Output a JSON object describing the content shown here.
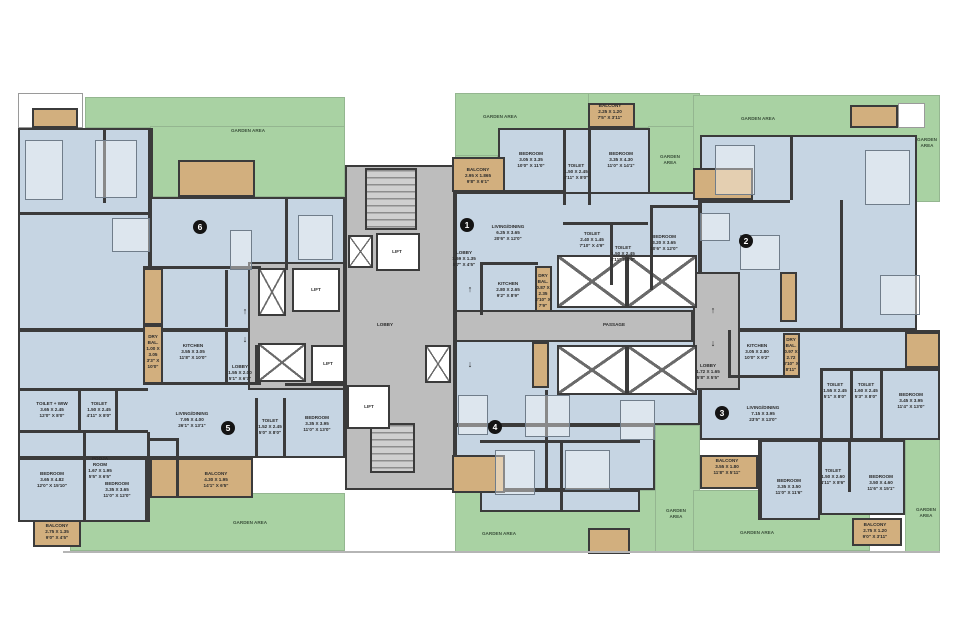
{
  "palette": {
    "garden_green": "#a9d2a3",
    "room_blue": "#c6d5e3",
    "balcony_tan": "#d2af7e",
    "core_gray": "#bdbdbd",
    "wall_dark": "#3b3b3b",
    "badge_black": "#141414",
    "background": "#ffffff"
  },
  "areas": [
    {
      "t": "garden",
      "x": 85,
      "y": 97,
      "w": 260,
      "h": 31
    },
    {
      "t": "garden",
      "x": 150,
      "y": 126,
      "w": 195,
      "h": 71
    },
    {
      "t": "garden",
      "x": 70,
      "y": 493,
      "w": 275,
      "h": 58
    },
    {
      "t": "garden",
      "x": 455,
      "y": 93,
      "w": 137,
      "h": 64
    },
    {
      "t": "garden",
      "x": 455,
      "y": 155,
      "w": 43,
      "h": 47
    },
    {
      "t": "garden",
      "x": 588,
      "y": 93,
      "w": 112,
      "h": 35
    },
    {
      "t": "garden",
      "x": 648,
      "y": 126,
      "w": 52,
      "h": 78
    },
    {
      "t": "garden",
      "x": 455,
      "y": 490,
      "w": 205,
      "h": 62
    },
    {
      "t": "garden",
      "x": 655,
      "y": 425,
      "w": 45,
      "h": 127
    },
    {
      "t": "garden",
      "x": 693,
      "y": 95,
      "w": 247,
      "h": 107
    },
    {
      "t": "garden",
      "x": 693,
      "y": 490,
      "w": 177,
      "h": 61
    },
    {
      "t": "garden",
      "x": 905,
      "y": 428,
      "w": 35,
      "h": 124
    },
    {
      "t": "room",
      "n": "unit-6-interior",
      "x": 18,
      "y": 128,
      "w": 132,
      "h": 202
    },
    {
      "t": "room",
      "n": "unit-6-interior",
      "x": 150,
      "y": 197,
      "w": 195,
      "h": 133
    },
    {
      "t": "room",
      "n": "unit-5-interior",
      "x": 18,
      "y": 330,
      "w": 327,
      "h": 128
    },
    {
      "t": "room",
      "n": "unit-5-interior",
      "x": 18,
      "y": 458,
      "w": 129,
      "h": 64
    },
    {
      "t": "room",
      "n": "unit-1-interior",
      "x": 498,
      "y": 128,
      "w": 152,
      "h": 97
    },
    {
      "t": "room",
      "n": "unit-1-interior",
      "x": 455,
      "y": 192,
      "w": 245,
      "h": 123
    },
    {
      "t": "room",
      "n": "unit-4-interior",
      "x": 455,
      "y": 340,
      "w": 245,
      "h": 85
    },
    {
      "t": "room",
      "n": "unit-4-interior",
      "x": 455,
      "y": 425,
      "w": 200,
      "h": 65
    },
    {
      "t": "room",
      "n": "unit-4-interior",
      "x": 480,
      "y": 490,
      "w": 160,
      "h": 22
    },
    {
      "t": "room",
      "n": "unit-2-interior",
      "x": 700,
      "y": 135,
      "w": 217,
      "h": 195
    },
    {
      "t": "room",
      "n": "unit-3-interior",
      "x": 700,
      "y": 330,
      "w": 240,
      "h": 110
    },
    {
      "t": "room",
      "n": "unit-3-interior",
      "x": 760,
      "y": 440,
      "w": 60,
      "h": 80
    },
    {
      "t": "room",
      "n": "unit-3-interior",
      "x": 820,
      "y": 440,
      "w": 85,
      "h": 75
    },
    {
      "t": "core",
      "n": "stair-lift-core",
      "x": 345,
      "y": 165,
      "w": 110,
      "h": 325
    },
    {
      "t": "core",
      "n": "lift-lobby",
      "x": 248,
      "y": 262,
      "w": 97,
      "h": 128
    },
    {
      "t": "core",
      "n": "passage",
      "x": 455,
      "y": 310,
      "w": 238,
      "h": 32
    },
    {
      "t": "core",
      "n": "entrance-lobby",
      "x": 693,
      "y": 272,
      "w": 47,
      "h": 118
    },
    {
      "t": "terrace",
      "x": 18,
      "y": 93,
      "w": 65,
      "h": 35
    },
    {
      "t": "terrace",
      "x": 898,
      "y": 103,
      "w": 27,
      "h": 25
    },
    {
      "t": "balcony",
      "x": 32,
      "y": 108,
      "w": 46,
      "h": 20
    },
    {
      "t": "balcony",
      "x": 178,
      "y": 160,
      "w": 77,
      "h": 37
    },
    {
      "t": "balcony",
      "x": 143,
      "y": 268,
      "w": 20,
      "h": 57
    },
    {
      "t": "balcony",
      "x": 143,
      "y": 325,
      "w": 20,
      "h": 60
    },
    {
      "t": "balcony",
      "x": 150,
      "y": 458,
      "w": 103,
      "h": 40
    },
    {
      "t": "balcony",
      "x": 33,
      "y": 520,
      "w": 48,
      "h": 27
    },
    {
      "t": "balcony",
      "x": 452,
      "y": 157,
      "w": 53,
      "h": 35
    },
    {
      "t": "balcony",
      "x": 588,
      "y": 103,
      "w": 47,
      "h": 25
    },
    {
      "t": "balcony",
      "x": 535,
      "y": 266,
      "w": 17,
      "h": 46
    },
    {
      "t": "balcony",
      "x": 532,
      "y": 342,
      "w": 17,
      "h": 46
    },
    {
      "t": "balcony",
      "x": 452,
      "y": 455,
      "w": 53,
      "h": 38
    },
    {
      "t": "balcony",
      "x": 588,
      "y": 528,
      "w": 42,
      "h": 26
    },
    {
      "t": "balcony",
      "x": 693,
      "y": 168,
      "w": 60,
      "h": 32
    },
    {
      "t": "balcony",
      "x": 850,
      "y": 105,
      "w": 48,
      "h": 23
    },
    {
      "t": "balcony",
      "x": 780,
      "y": 272,
      "w": 17,
      "h": 50
    },
    {
      "t": "balcony",
      "x": 905,
      "y": 332,
      "w": 35,
      "h": 36
    },
    {
      "t": "balcony",
      "x": 783,
      "y": 333,
      "w": 17,
      "h": 44
    },
    {
      "t": "balcony",
      "x": 700,
      "y": 455,
      "w": 58,
      "h": 34
    },
    {
      "t": "balcony",
      "x": 852,
      "y": 518,
      "w": 50,
      "h": 28
    }
  ],
  "voids": [
    {
      "x": 258,
      "y": 268,
      "w": 28,
      "h": 48
    },
    {
      "x": 348,
      "y": 235,
      "w": 25,
      "h": 33
    },
    {
      "x": 258,
      "y": 343,
      "w": 48,
      "h": 39
    },
    {
      "x": 425,
      "y": 345,
      "w": 26,
      "h": 38
    },
    {
      "x": 557,
      "y": 255,
      "w": 70,
      "h": 53
    },
    {
      "x": 627,
      "y": 255,
      "w": 70,
      "h": 53
    },
    {
      "x": 557,
      "y": 345,
      "w": 70,
      "h": 50
    },
    {
      "x": 627,
      "y": 345,
      "w": 70,
      "h": 50
    }
  ],
  "stairs": [
    {
      "x": 365,
      "y": 168,
      "w": 52,
      "h": 62
    },
    {
      "x": 370,
      "y": 423,
      "w": 45,
      "h": 50
    }
  ],
  "lifts": [
    {
      "x": 292,
      "y": 268,
      "w": 48,
      "h": 44
    },
    {
      "x": 376,
      "y": 233,
      "w": 44,
      "h": 38
    },
    {
      "x": 311,
      "y": 345,
      "w": 34,
      "h": 38
    },
    {
      "x": 347,
      "y": 385,
      "w": 43,
      "h": 44
    }
  ],
  "walls": [
    {
      "x": 225,
      "y": 328,
      "w": 3,
      "h": 57
    },
    {
      "x": 143,
      "y": 382,
      "w": 118,
      "h": 3
    },
    {
      "x": 255,
      "y": 345,
      "w": 3,
      "h": 40
    },
    {
      "x": 255,
      "y": 398,
      "w": 3,
      "h": 60
    },
    {
      "x": 283,
      "y": 398,
      "w": 3,
      "h": 60
    },
    {
      "x": 285,
      "y": 383,
      "w": 60,
      "h": 3
    },
    {
      "x": 18,
      "y": 388,
      "w": 130,
      "h": 3
    },
    {
      "x": 78,
      "y": 390,
      "w": 3,
      "h": 42
    },
    {
      "x": 115,
      "y": 390,
      "w": 3,
      "h": 42
    },
    {
      "x": 18,
      "y": 430,
      "w": 130,
      "h": 3
    },
    {
      "x": 83,
      "y": 432,
      "w": 3,
      "h": 90
    },
    {
      "x": 147,
      "y": 432,
      "w": 3,
      "h": 90
    },
    {
      "x": 147,
      "y": 438,
      "w": 30,
      "h": 3
    },
    {
      "x": 176,
      "y": 438,
      "w": 3,
      "h": 60
    },
    {
      "x": 225,
      "y": 270,
      "w": 3,
      "h": 57
    },
    {
      "x": 143,
      "y": 266,
      "w": 118,
      "h": 3
    },
    {
      "x": 285,
      "y": 197,
      "w": 3,
      "h": 73
    },
    {
      "x": 150,
      "y": 128,
      "w": 3,
      "h": 70
    },
    {
      "x": 103,
      "y": 128,
      "w": 3,
      "h": 75
    },
    {
      "x": 18,
      "y": 212,
      "w": 132,
      "h": 3
    },
    {
      "x": 563,
      "y": 128,
      "w": 3,
      "h": 77
    },
    {
      "x": 588,
      "y": 128,
      "w": 3,
      "h": 77
    },
    {
      "x": 498,
      "y": 190,
      "w": 65,
      "h": 3
    },
    {
      "x": 650,
      "y": 205,
      "w": 50,
      "h": 3
    },
    {
      "x": 650,
      "y": 205,
      "w": 3,
      "h": 85
    },
    {
      "x": 563,
      "y": 222,
      "w": 85,
      "h": 3
    },
    {
      "x": 610,
      "y": 225,
      "w": 3,
      "h": 60
    },
    {
      "x": 480,
      "y": 262,
      "w": 3,
      "h": 53
    },
    {
      "x": 480,
      "y": 262,
      "w": 58,
      "h": 3
    },
    {
      "x": 728,
      "y": 330,
      "w": 3,
      "h": 48
    },
    {
      "x": 728,
      "y": 375,
      "w": 72,
      "h": 3
    },
    {
      "x": 820,
      "y": 368,
      "w": 3,
      "h": 72
    },
    {
      "x": 850,
      "y": 368,
      "w": 3,
      "h": 72
    },
    {
      "x": 880,
      "y": 368,
      "w": 3,
      "h": 72
    },
    {
      "x": 820,
      "y": 368,
      "w": 120,
      "h": 3
    },
    {
      "x": 758,
      "y": 440,
      "w": 3,
      "h": 80
    },
    {
      "x": 848,
      "y": 440,
      "w": 3,
      "h": 52
    },
    {
      "x": 790,
      "y": 135,
      "w": 3,
      "h": 65
    },
    {
      "x": 840,
      "y": 200,
      "w": 3,
      "h": 130
    },
    {
      "x": 700,
      "y": 200,
      "w": 90,
      "h": 3
    },
    {
      "x": 545,
      "y": 390,
      "w": 3,
      "h": 100
    },
    {
      "x": 480,
      "y": 440,
      "w": 160,
      "h": 3
    },
    {
      "x": 560,
      "y": 442,
      "w": 3,
      "h": 70
    }
  ],
  "edges": [
    {
      "x": 63,
      "y": 551,
      "w": 877,
      "h": 2
    }
  ],
  "furniture": [
    {
      "n": "bed",
      "x": 25,
      "y": 140,
      "w": 38,
      "h": 60
    },
    {
      "n": "bed",
      "x": 95,
      "y": 140,
      "w": 42,
      "h": 58
    },
    {
      "n": "dining-table",
      "x": 112,
      "y": 218,
      "w": 38,
      "h": 34
    },
    {
      "n": "sofa",
      "x": 230,
      "y": 230,
      "w": 22,
      "h": 40
    },
    {
      "n": "bed",
      "x": 298,
      "y": 215,
      "w": 35,
      "h": 45
    },
    {
      "n": "bed",
      "x": 715,
      "y": 145,
      "w": 40,
      "h": 50
    },
    {
      "n": "bed",
      "x": 865,
      "y": 150,
      "w": 45,
      "h": 55
    },
    {
      "n": "dining-table",
      "x": 740,
      "y": 235,
      "w": 40,
      "h": 35
    },
    {
      "n": "sofa",
      "x": 700,
      "y": 213,
      "w": 30,
      "h": 28
    },
    {
      "n": "bed",
      "x": 880,
      "y": 275,
      "w": 40,
      "h": 40
    },
    {
      "n": "sofa",
      "x": 458,
      "y": 395,
      "w": 30,
      "h": 40
    },
    {
      "n": "dining-table",
      "x": 525,
      "y": 395,
      "w": 45,
      "h": 42
    },
    {
      "n": "bed",
      "x": 495,
      "y": 450,
      "w": 40,
      "h": 45
    },
    {
      "n": "bed",
      "x": 565,
      "y": 450,
      "w": 45,
      "h": 40
    },
    {
      "n": "bed",
      "x": 620,
      "y": 400,
      "w": 35,
      "h": 40
    }
  ],
  "labels": [
    {
      "g": true,
      "t": "GARDEN AREA",
      "x": 248,
      "y": 131,
      "w": 60
    },
    {
      "g": true,
      "t": "GARDEN AREA",
      "x": 250,
      "y": 523,
      "w": 60
    },
    {
      "g": true,
      "t": "GARDEN AREA",
      "x": 500,
      "y": 117,
      "w": 60
    },
    {
      "g": true,
      "t": "GARDEN\nAREA",
      "x": 670,
      "y": 160,
      "w": 32
    },
    {
      "g": true,
      "t": "GARDEN AREA",
      "x": 499,
      "y": 534,
      "w": 60
    },
    {
      "g": true,
      "t": "GARDEN\nAREA",
      "x": 676,
      "y": 514,
      "w": 32
    },
    {
      "g": true,
      "t": "GARDEN AREA",
      "x": 758,
      "y": 119,
      "w": 60
    },
    {
      "g": true,
      "t": "GARDEN\nAREA",
      "x": 927,
      "y": 143,
      "w": 32
    },
    {
      "g": true,
      "t": "GARDEN AREA",
      "x": 757,
      "y": 533,
      "w": 60
    },
    {
      "g": true,
      "t": "GARDEN\nAREA",
      "x": 926,
      "y": 513,
      "w": 32
    },
    {
      "t": "DRY\nBAL.\n1.00 X\n3.05\n3'3\" X\n10'0\"",
      "x": 153,
      "y": 352,
      "w": 20
    },
    {
      "t": "KITCHEN\n3.55 X 3.05\n11'8\" X 10'0\"",
      "x": 193,
      "y": 352,
      "w": 55
    },
    {
      "t": "LOBBY\n1.55 X 2.00\n5'1\" X 6'7\"",
      "x": 240,
      "y": 373,
      "w": 42
    },
    {
      "t": "LIVING/DINING\n7.95 X 4.00\n26'1\" X 13'1\"",
      "x": 192,
      "y": 420,
      "w": 62
    },
    {
      "t": "TOILET\n1.52 X 2.45\n5'0\" X 8'0\"",
      "x": 270,
      "y": 427,
      "w": 40
    },
    {
      "t": "BEDROOM\n3.35 X 3.95\n11'0\" X 13'0\"",
      "x": 317,
      "y": 424,
      "w": 52
    },
    {
      "t": "POOJA\nROOM\n1.67 X 1.95\n5'5\" X 6'5\"",
      "x": 100,
      "y": 468,
      "w": 40
    },
    {
      "t": "BALCONY\n4.30 X 1.95\n14'1\" X 6'5\"",
      "x": 216,
      "y": 480,
      "w": 52
    },
    {
      "t": "TOILET + WIW\n3.65 X 2.45\n12'0\" X 8'0\"",
      "x": 52,
      "y": 410,
      "w": 55
    },
    {
      "t": "TOILET\n1.50 X 2.45\n4'11\" X 8'0\"",
      "x": 99,
      "y": 410,
      "w": 40
    },
    {
      "t": "BEDROOM\n3.65 X 4.82\n12'0\" X 15'10\"",
      "x": 52,
      "y": 480,
      "w": 52
    },
    {
      "t": "BEDROOM\n3.35 X 3.65\n11'0\" X 12'0\"",
      "x": 117,
      "y": 490,
      "w": 52
    },
    {
      "t": "BALCONY\n2.75 X 1.35\n9'0\" X 4'5\"",
      "x": 57,
      "y": 532,
      "w": 45
    },
    {
      "t": "LIFT",
      "x": 316,
      "y": 290,
      "w": 30
    },
    {
      "t": "LIFT",
      "x": 397,
      "y": 252,
      "w": 30
    },
    {
      "t": "LIFT",
      "x": 328,
      "y": 364,
      "w": 30
    },
    {
      "t": "LIFT",
      "x": 369,
      "y": 407,
      "w": 30
    },
    {
      "t": "LOBBY",
      "x": 385,
      "y": 325,
      "w": 40
    },
    {
      "t": "PASSAGE",
      "x": 614,
      "y": 325,
      "w": 50
    },
    {
      "t": "BALCONY\n2.95 X 1.865\n9'8\" X 6'1\"",
      "x": 478,
      "y": 176,
      "w": 52
    },
    {
      "t": "BALCONY\n2.25 X 1.20\n7'5\" X 3'11\"",
      "x": 610,
      "y": 112,
      "w": 48
    },
    {
      "t": "BEDROOM\n3.05 X 3.35\n10'0\" X 11'0\"",
      "x": 531,
      "y": 160,
      "w": 52
    },
    {
      "t": "TOILET\n1.50 X 2.45\n4'11\" X 8'0\"",
      "x": 576,
      "y": 172,
      "w": 30
    },
    {
      "t": "BEDROOM\n3.35 X 4.30\n11'0\" X 14'1\"",
      "x": 621,
      "y": 160,
      "w": 52
    },
    {
      "t": "LIVING/DINING\n6.25 X 3.65\n20'6\" X 12'0\"",
      "x": 508,
      "y": 233,
      "w": 62
    },
    {
      "t": "TOILET\n2.40 X 1.45\n7'10\" X 4'9\"",
      "x": 592,
      "y": 240,
      "w": 45
    },
    {
      "t": "TOILET\n1.50 X 2.45\n4'11\" X 8'0\"",
      "x": 623,
      "y": 254,
      "w": 40
    },
    {
      "t": "BEDROOM\n3.20 X 3.65\n10'6\" X 12'0\"",
      "x": 664,
      "y": 243,
      "w": 50
    },
    {
      "t": "LOBBY\n1.69 X 1.35\n5'7\" X 4'5\"",
      "x": 464,
      "y": 259,
      "w": 40
    },
    {
      "t": "KITCHEN\n2.80 X 2.65\n9'2\" X 8'9\"",
      "x": 508,
      "y": 290,
      "w": 50
    },
    {
      "t": "DRY\nBAL.\n0.87 X\n2.35\n2'10\" X\n7'9\"",
      "x": 543,
      "y": 291,
      "w": 18
    },
    {
      "t": "KITCHEN\n3.05 X 2.80\n10'0\" X 9'2\"",
      "x": 757,
      "y": 352,
      "w": 50
    },
    {
      "t": "DRY\nBAL.\n0.97 X\n2.72\n3'10\" X\n8'11\"",
      "x": 791,
      "y": 355,
      "w": 18
    },
    {
      "t": "LOBBY\n1.72 X 1.65\n5'8\" X 5'5\"",
      "x": 708,
      "y": 372,
      "w": 40
    },
    {
      "t": "LIVING/DINING\n7.15 X 3.95\n23'5\" X 13'0\"",
      "x": 763,
      "y": 414,
      "w": 62
    },
    {
      "t": "TOILET\n1.55 X 2.45\n5'1\" X 8'0\"",
      "x": 835,
      "y": 391,
      "w": 30
    },
    {
      "t": "TOILET\n1.60 X 2.45\n5'3\" X 8'0\"",
      "x": 866,
      "y": 391,
      "w": 30
    },
    {
      "t": "BEDROOM\n3.45 X 3.95\n11'4\" X 13'0\"",
      "x": 911,
      "y": 401,
      "w": 50
    },
    {
      "t": "TOILET\n1.50 X 2.60\n4'11\" X 8'6\"",
      "x": 833,
      "y": 477,
      "w": 32
    },
    {
      "t": "BEDROOM\n3.50 X 4.60\n11'6\" X 15'1\"",
      "x": 881,
      "y": 483,
      "w": 50
    },
    {
      "t": "BALCONY\n3.55 X 1.80\n11'8\" X 5'11\"",
      "x": 727,
      "y": 467,
      "w": 50
    },
    {
      "t": "BEDROOM\n3.35 X 3.50\n11'0\" X 11'6\"",
      "x": 789,
      "y": 487,
      "w": 50
    },
    {
      "t": "BALCONY\n2.75 X 1.20\n9'0\" X 3'11\"",
      "x": 875,
      "y": 531,
      "w": 48
    }
  ],
  "badges": [
    {
      "n": "6",
      "x": 200,
      "y": 227
    },
    {
      "n": "5",
      "x": 228,
      "y": 428
    },
    {
      "n": "1",
      "x": 467,
      "y": 225
    },
    {
      "n": "4",
      "x": 495,
      "y": 427
    },
    {
      "n": "2",
      "x": 746,
      "y": 241
    },
    {
      "n": "3",
      "x": 722,
      "y": 413
    }
  ],
  "arrows": [
    {
      "d": "up",
      "g": "↑",
      "x": 245,
      "y": 311
    },
    {
      "d": "down",
      "g": "↓",
      "x": 245,
      "y": 339
    },
    {
      "d": "up",
      "g": "↑",
      "x": 470,
      "y": 289
    },
    {
      "d": "down",
      "g": "↓",
      "x": 470,
      "y": 364
    },
    {
      "d": "up",
      "g": "↑",
      "x": 713,
      "y": 310
    },
    {
      "d": "down",
      "g": "↓",
      "x": 713,
      "y": 343
    }
  ]
}
